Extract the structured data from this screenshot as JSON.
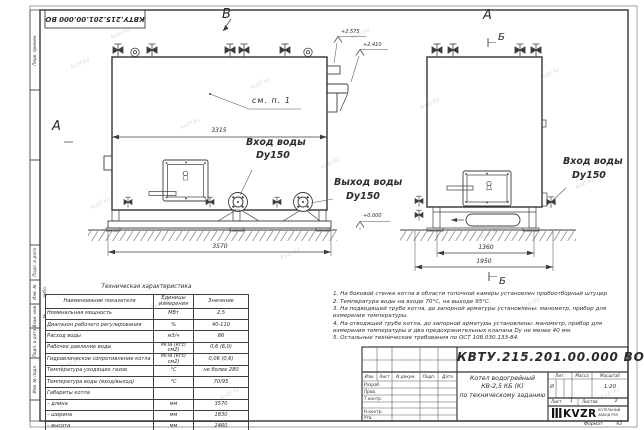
{
  "margin": {
    "perv_primen": "Перв. примен.",
    "podp_data_1": "Подп. и дата",
    "inv_dubl": "Инв. № дубл.",
    "vzam_inv": "Взам. инв. №",
    "podp_data_2": "Подп. и дата",
    "inv_podl": "Инв. № подл."
  },
  "drawing": {
    "view_label_v": "В",
    "view_label_a_left": "А",
    "view_label_a_right": "А",
    "section_b_top": "Б",
    "section_b_bottom": "Б",
    "see_note": "см. п. 1",
    "dims": {
      "body_length": "3315",
      "base_length": "3570",
      "side_inner": "1360",
      "side_outer": "1950"
    },
    "elevations": {
      "top": "+2.575",
      "mid": "+2.410",
      "zero": "+0.000"
    },
    "labels": {
      "inlet_front_1": "Вход воды",
      "inlet_front_2": "Dy150",
      "outlet_front_1": "Выход воды",
      "outlet_front_2": "Dy150",
      "inlet_side_1": "Вход воды",
      "inlet_side_2": "Dy150"
    }
  },
  "tech_table": {
    "title": "Техническая характеристика",
    "col_name": "Наименование показателя",
    "col_units": "Единицы измерения",
    "col_value": "Значение",
    "rows": [
      {
        "name": "Номинальная мощность",
        "units": "МВт",
        "value": "2,5"
      },
      {
        "name": "Диапазон рабочего регулирования",
        "units": "%",
        "value": "40-110"
      },
      {
        "name": "Расход воды",
        "units": "м3/ч",
        "value": "86"
      },
      {
        "name": "Рабочее давление воды",
        "units": "МПа (кгс/см2)",
        "value": "0,6 (6,0)"
      },
      {
        "name": "Гидравлическое сопротивление котла",
        "units": "МПа (кгс/см2)",
        "value": "0,06 (0,6)"
      },
      {
        "name": "Температура уходящих газов",
        "units": "°С",
        "value": "не более 280"
      },
      {
        "name": "Температура воды (вход/выход)",
        "units": "°С",
        "value": "70/95"
      },
      {
        "name": "Габариты котла",
        "units": "",
        "value": ""
      },
      {
        "name": "– длина",
        "units": "мм",
        "value": "3570"
      },
      {
        "name": "– ширина",
        "units": "мм",
        "value": "1830"
      },
      {
        "name": "– высота",
        "units": "мм",
        "value": "2460"
      }
    ]
  },
  "notes": [
    "1. На боковой стенке котла в области топочной камеры установлен пробоотборный штуцер",
    "2. Температура воды на входе 70°С, на выходе 95°С.",
    "3. На подводящей трубе котла, до запорной арматуры установлены: манометр, прибор для измерения температуры.",
    "4. На отводящей трубе котла, до запорной арматуры установлены: манометр, прибор для измерения температуры и два предохранительных клапана Dу не менее 40 мм.",
    "5. Остальные технические требования по ОСТ 108.030.133-84."
  ],
  "title_block": {
    "doc_number": "КВТУ.215.201.00.000 ВО",
    "cols": {
      "izm": "Изм.",
      "list": "Лист",
      "ndoc": "N докум.",
      "podp": "Подп.",
      "data": "Дата"
    },
    "rows": {
      "razrab": "Разраб.",
      "prov": "Пров.",
      "tkontr": "Т.контр.",
      "nkontr": "Н.контр.",
      "utv": "Утв."
    },
    "product_1": "Котел водогрейный",
    "product_2": "КВ-2,5 КБ (К)",
    "product_3": "по техническому заданию",
    "lit_h": "Лит.",
    "mass_h": "Масса",
    "scale_h": "Масштаб",
    "lit_v": "И",
    "scale_v": "1:20",
    "sheet_h": "Лист",
    "sheet_v": "1",
    "sheets_h": "Листов",
    "sheets_v": "2",
    "logo": "KVZR",
    "logo_sub1": "КОТЕЛЬНЫЙ",
    "logo_sub2": "ЗАВОД РЭП",
    "format_h": "Формат",
    "format_v": "А3"
  },
  "watermark": {
    "text": "kvzr.kz"
  }
}
